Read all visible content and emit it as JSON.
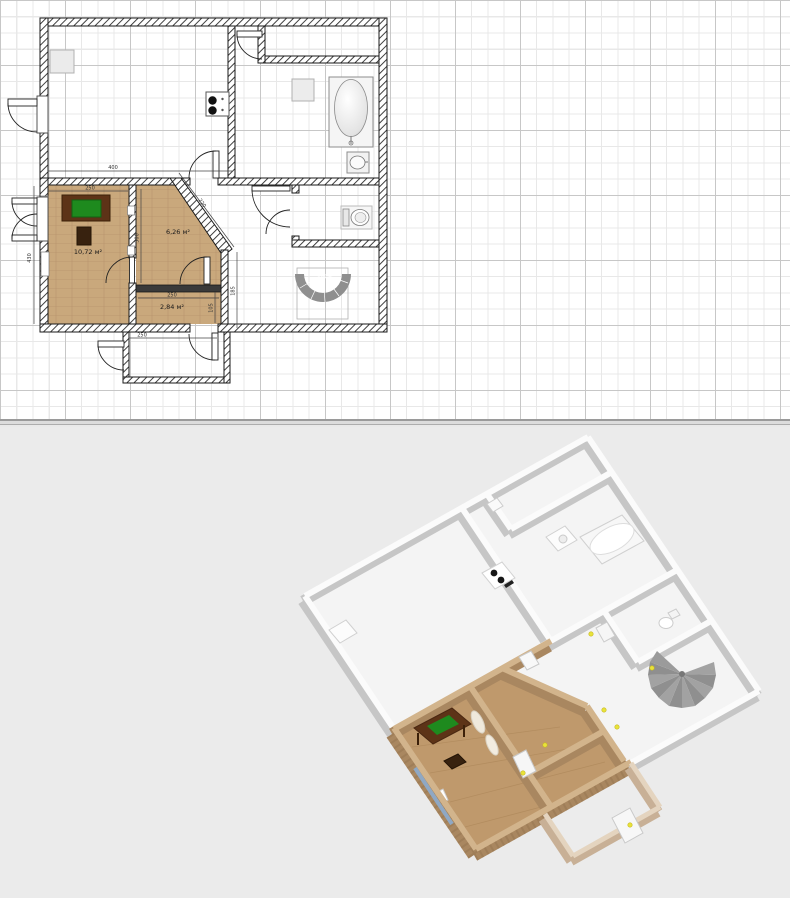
{
  "app": {
    "name": "floor-plan-editor"
  },
  "plan2d": {
    "rooms": [
      {
        "area": "10,72 м²"
      },
      {
        "area": "6,26 м²"
      },
      {
        "area": "2,84 м²"
      }
    ],
    "dimensions": {
      "kitchen_width": "400",
      "room1_width": "250",
      "room1_height": "430",
      "room2_height": "300",
      "diagonal_wall": "220",
      "hall_right": "185",
      "room3_right": "105",
      "room3_width": "250",
      "porch_width": "250"
    },
    "fixtures": [
      "window",
      "stove",
      "bathtub",
      "sink",
      "shower-tray",
      "toilet",
      "spiral-staircase",
      "desk",
      "chair",
      "radiator",
      "doors"
    ],
    "colors": {
      "wood_floor": "#c9a87c",
      "wall_outline": "#1a1a1a",
      "stairs": "#8f8f8f",
      "desk_top": "#1e8a1e",
      "grid_major": "#c7c7c7",
      "grid_minor": "#e8e8e8"
    }
  },
  "view3d": {
    "background": "#ebebeb",
    "wall_white": "#f7f7f7",
    "wall_wood": "#a98760",
    "wall_porch": "#cdb59c",
    "floor_wood": "#bf996c",
    "marker_color": "#e8e33a",
    "fixtures": [
      "stove",
      "washing-machine",
      "bathtub",
      "toilet",
      "spiral-staircase",
      "desk",
      "chair",
      "radiator",
      "door-panels"
    ]
  }
}
